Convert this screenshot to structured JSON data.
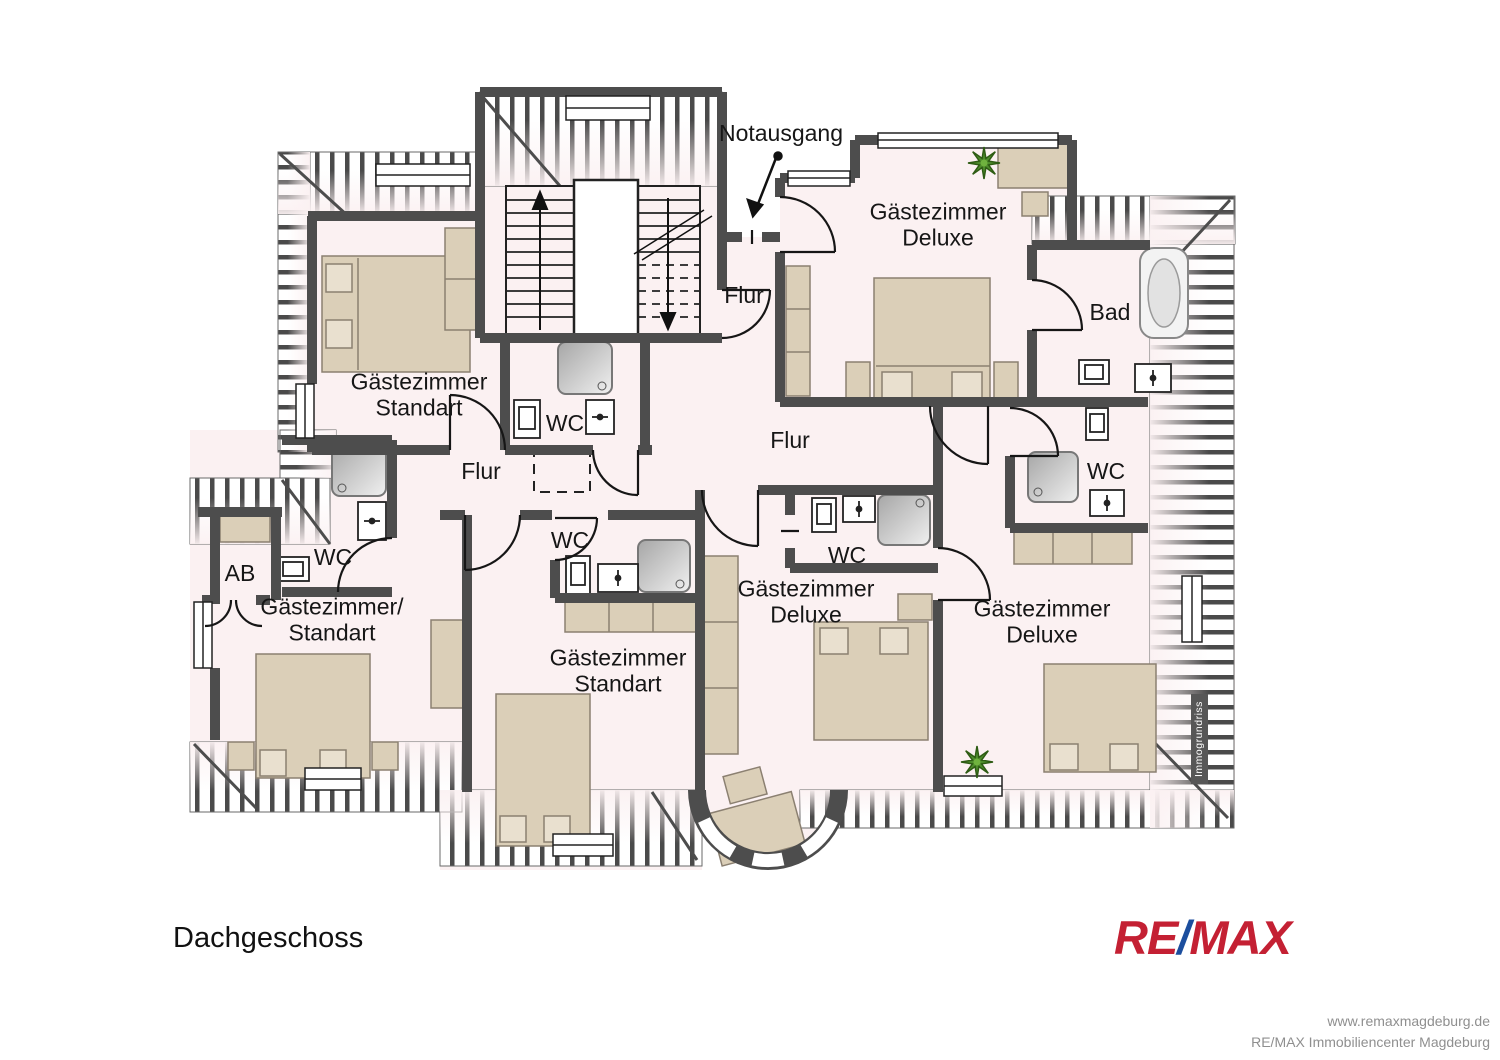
{
  "page": {
    "floor_title": "Dachgeschoss",
    "branding": {
      "re": "RE",
      "slash": "/",
      "max": "MAX"
    },
    "footer": {
      "line1": "www.remaxmagdeburg.de",
      "line2": "RE/MAX Immobiliencenter Magdeburg"
    },
    "watermark": "Immogrundriss"
  },
  "palette": {
    "floor": "#fbf1f2",
    "wall": "#4d4d4d",
    "furniture": "#dbcfb8",
    "brand_red": "#c42033",
    "brand_blue": "#1c4e9e"
  },
  "plan": {
    "exit_label": "Notausgang",
    "labels": {
      "room_tl": "Gästezimmer\nStandart",
      "room_tr": "Gästezimmer\nDeluxe",
      "bad": "Bad",
      "flur_top": "Flur",
      "flur_main": "Flur",
      "flur_left": "Flur",
      "wc_stairs": "WC",
      "wc_left": "WC",
      "ab": "AB",
      "room_left": "Gästezimmer/\nStandart",
      "wc_center": "WC",
      "room_bottom": "Gästezimmer\nStandart",
      "wc_mid": "WC",
      "room_mid": "Gästezimmer\nDeluxe",
      "wc_right": "WC",
      "room_right": "Gästezimmer\nDeluxe"
    }
  }
}
